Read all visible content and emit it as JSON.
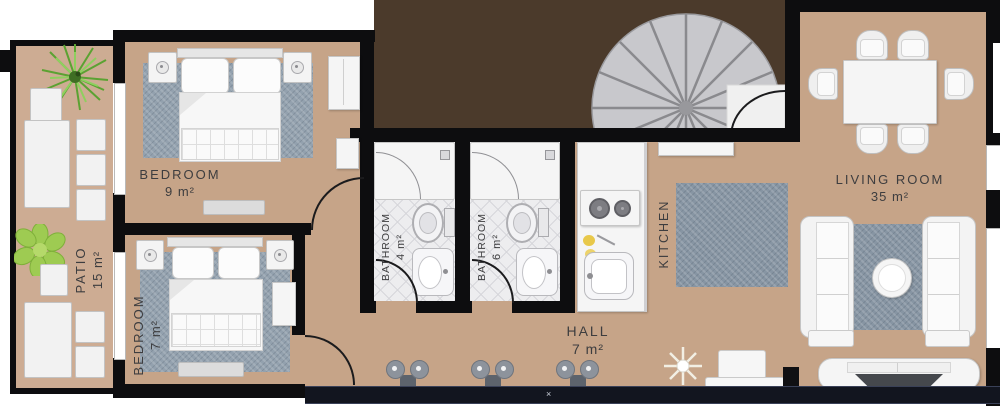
{
  "title": "Apartment floor plan",
  "labels": {
    "patio": {
      "name": "PATIO",
      "area": "15 m²"
    },
    "bedroom_9": {
      "name": "BEDROOM",
      "area": "9 m²"
    },
    "bedroom_7": {
      "name": "BEDROOM",
      "area": "7 m²"
    },
    "bathroom_4": {
      "name": "BATHROOM",
      "area": "4 m²"
    },
    "bathroom_6": {
      "name": "BATHROOM",
      "area": "6 m²"
    },
    "kitchen": {
      "name": "KITCHEN"
    },
    "hall": {
      "name": "HALL",
      "area": "7 m²"
    },
    "living_room": {
      "name": "LIVING ROOM",
      "area": "35 m²"
    }
  },
  "marks": {
    "bottom_wall": "×"
  },
  "colors": {
    "floor_tan": "#c6a488",
    "patio_tan": "#cdac93",
    "wall_black": "#0d0d0f",
    "upper_void_brown": "#4b3a2b",
    "bottom_wall_navy": "#12151f",
    "rug_blue_gray": "#93a1ae",
    "stair_gray": "#c8c8cc",
    "plant_green": "#68b33b",
    "accent_yellow": "#e8c84a"
  }
}
